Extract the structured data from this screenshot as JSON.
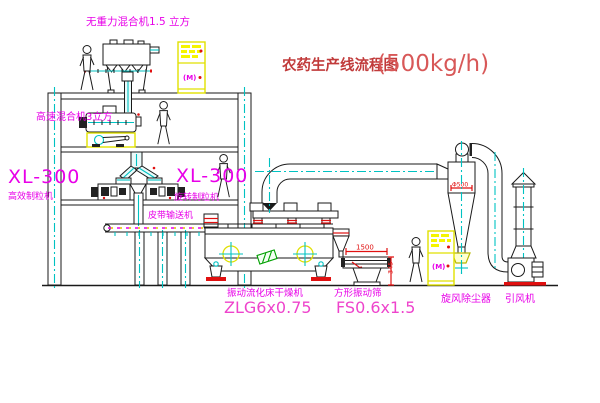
{
  "title": {
    "name_cn": "农药生产线流程图",
    "capacity": "(500kg/h)"
  },
  "equipment_labels": {
    "gravity_mixer": "无重力混合机1.5 立方",
    "high_speed_mixer": "高速混合机3立方",
    "granulator_left_model": "XL-300",
    "granulator_left_name": "高效制粒机",
    "granulator_right_model": "XL-300",
    "granulator_right_name": "旋转制粒机",
    "belt_conveyor": "皮带输送机",
    "dryer_name": "振动流化床干燥机",
    "dryer_model": "ZLG6x0.75",
    "sieve_name": "方形振动筛",
    "sieve_model": "FS0.6x1.5",
    "cyclone": "旋风除尘器",
    "fan": "引风机"
  },
  "dimensions": {
    "sieve_length": "1500",
    "sieve_height": "345",
    "cyclone_diameter": "Φ500"
  },
  "control_cabinet": {
    "display_text": "(M)"
  },
  "colors": {
    "line": "#1a1a1a",
    "centerline_cyan": "#00c2c2",
    "label_magenta": "#e800e8",
    "title_red": "#c13b3b",
    "dimension_red": "#e01010",
    "highlight_yellow": "#e8e800",
    "accent_green": "#00a000"
  }
}
